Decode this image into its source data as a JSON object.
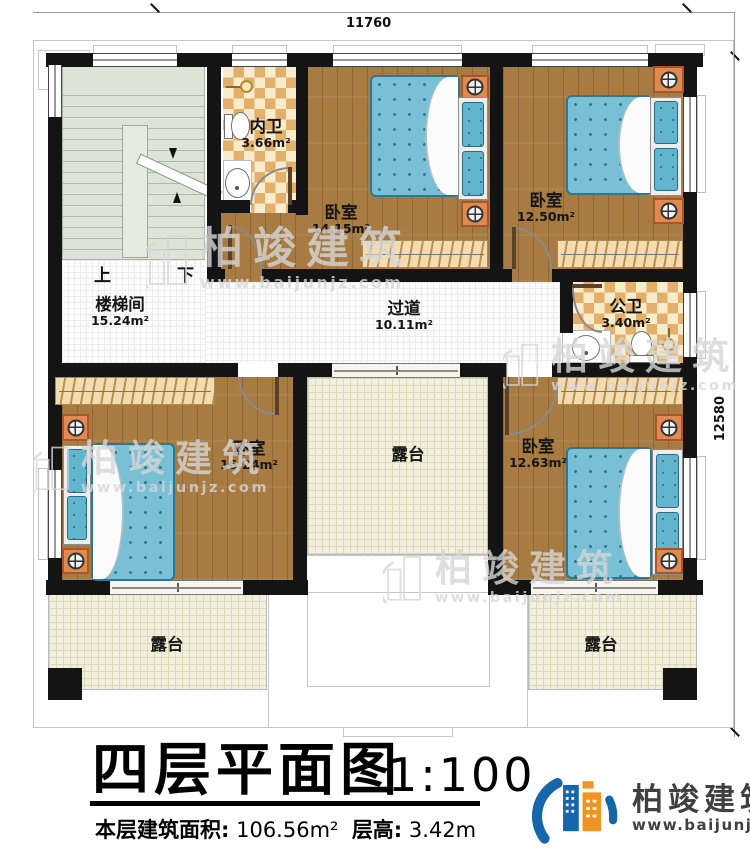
{
  "dims": {
    "top": "11760",
    "right": "12580"
  },
  "rooms": [
    {
      "id": "stairwell",
      "label": "楼梯间",
      "area": "15.24m²"
    },
    {
      "id": "inner-bathroom",
      "label": "内卫",
      "area": "3.66m²"
    },
    {
      "id": "bedroom-top-middle",
      "label": "卧室",
      "area": "14.15m²"
    },
    {
      "id": "bedroom-top-right",
      "label": "卧室",
      "area": "12.50m²"
    },
    {
      "id": "corridor",
      "label": "过道",
      "area": "10.11m²"
    },
    {
      "id": "public-bathroom",
      "label": "公卫",
      "area": "3.40m²"
    },
    {
      "id": "bedroom-bottom-left",
      "label": "卧室",
      "area": "16.24m²"
    },
    {
      "id": "bedroom-bottom-right",
      "label": "卧室",
      "area": "12.63m²"
    },
    {
      "id": "terrace-center",
      "label": "露台",
      "area": ""
    },
    {
      "id": "terrace-bottom-left",
      "label": "露台",
      "area": ""
    },
    {
      "id": "terrace-bottom-right",
      "label": "露台",
      "area": ""
    }
  ],
  "stairs": {
    "up": "上",
    "down": "下"
  },
  "title": {
    "name": "四层平面图",
    "scale": "1:100"
  },
  "info": {
    "area_label": "本层建筑面积:",
    "area_value": "106.56m²",
    "height_label": "层高:",
    "height_value": "3.42m"
  },
  "logo": {
    "name": "柏竣建筑",
    "url": "www.baijunjz.com"
  },
  "watermark": {
    "name": "柏竣建筑",
    "url": "www.baijunjz.com"
  },
  "colors": {
    "wall": "#141414",
    "wood_floor": "#a87b42",
    "mattress_blue": "#79c0d6",
    "checker_tile": "#e2b06b",
    "terrace": "#f2efdc",
    "stairs": "#dce3d7",
    "nightstand": "#e08a52",
    "wardrobe": "#f3ddb0",
    "logo_blue": "#1666ab",
    "logo_orange": "#f29422"
  }
}
